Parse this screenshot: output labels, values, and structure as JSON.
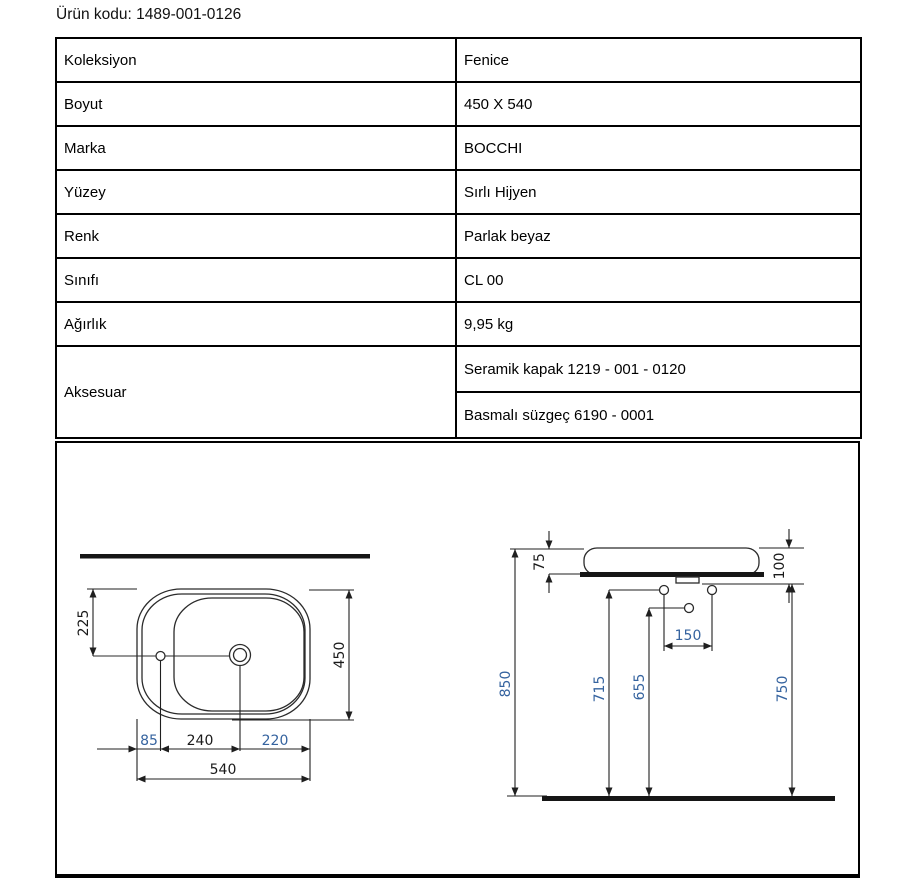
{
  "page": {
    "title": "Ürün kodu: 1489-001-0126"
  },
  "table": {
    "rows": [
      {
        "label": "Koleksiyon",
        "value": "Fenice"
      },
      {
        "label": "Boyut",
        "value": "450 X 540"
      },
      {
        "label": "Marka",
        "value": "BOCCHI"
      },
      {
        "label": "Yüzey",
        "value": "Sırlı Hijyen"
      },
      {
        "label": "Renk",
        "value": "Parlak beyaz"
      },
      {
        "label": "Sınıfı",
        "value": "CL 00"
      },
      {
        "label": "Ağırlık",
        "value": "9,95 kg"
      },
      {
        "label": "Aksesuar",
        "value": "Seramik kapak 1219 - 001 - 0120",
        "value2": "Basmalı süzgeç 6190 - 0001"
      }
    ]
  },
  "drawing": {
    "colors": {
      "dim_blue": "#35639f",
      "line": "#2b2b2b",
      "text": "#1a1a1a"
    },
    "top_view": {
      "dims": {
        "hole_offset_y": "225",
        "depth": "450",
        "edge_to_faucet": "85",
        "faucet_to_drain": "240",
        "drain_to_edge": "220",
        "width": "540"
      }
    },
    "side_view": {
      "dims": {
        "basin_height": "75",
        "rim_total": "100",
        "supply_spacing": "150",
        "total_height": "850",
        "supply_height": "715",
        "drain_height": "655",
        "counter_height": "750"
      }
    }
  }
}
